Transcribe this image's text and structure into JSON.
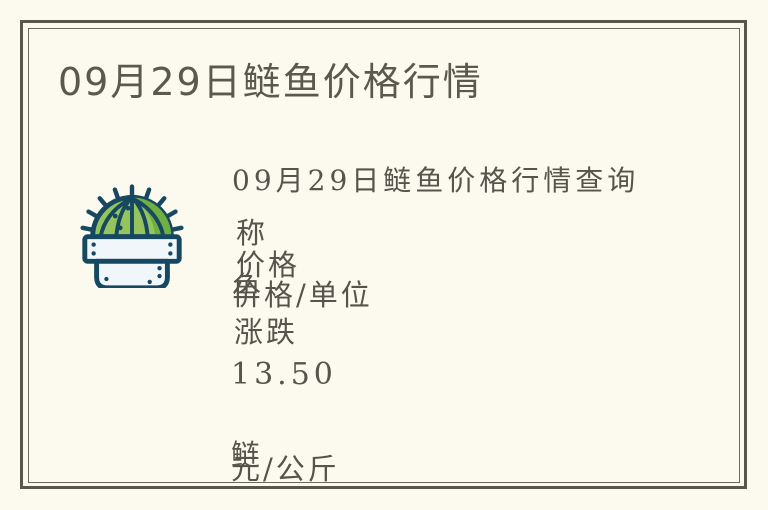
{
  "page": {
    "title": "09月29日鲢鱼价格行情"
  },
  "content": {
    "heading": "09月29日鲢鱼价格行情查询",
    "table": {
      "name_header_partial": "称",
      "price_header": "价格",
      "fish_char_overlap": "鱼",
      "price_unit_header": "价格/单位",
      "change_header": "涨跌",
      "price_value": "13.50",
      "fish_name_partial": "鲢",
      "unit_value": "元/公斤"
    }
  },
  "icon": {
    "name": "cactus-in-pot"
  },
  "colors": {
    "background": "#FCFAEF",
    "frame": "#57574B",
    "frame_inner": "#6B6C5F",
    "title": "#5B584E",
    "text": "#57544B",
    "cactus_green": "#95C45C",
    "cactus_dark_green": "#70AF41",
    "cactus_outline": "#174861",
    "pot_fill": "#F0F6F9"
  }
}
